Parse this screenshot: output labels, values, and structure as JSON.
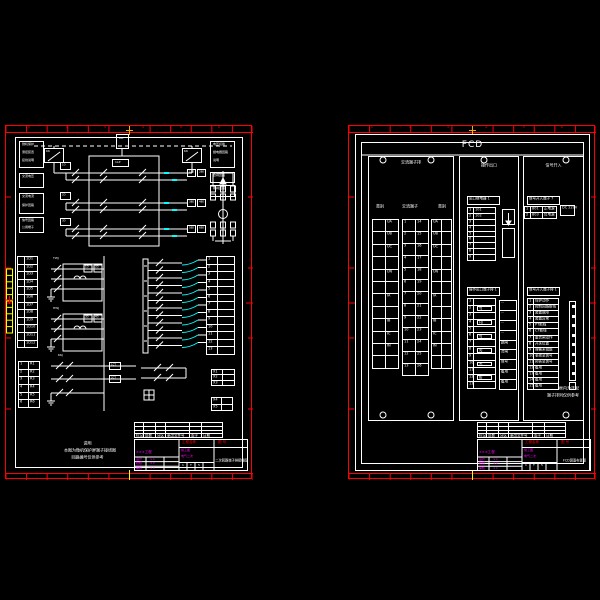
{
  "canvas": {
    "background": "#000000"
  },
  "palette": {
    "line": "#ffffff",
    "frame": "#ff0000",
    "highlight": "#ffff00",
    "wire_accent": "#00ffff",
    "fill_text": "#ff00ff",
    "center_mark": "#ffaa00"
  },
  "left_sheet": {
    "zone_numbers": [
      "1",
      "2",
      "3",
      "4",
      "5",
      "6"
    ],
    "legend_boxes": [
      [
        "微机保护",
        "测控装置",
        "接线说明"
      ],
      [
        "交流电压"
      ],
      [
        "交流电流",
        "保护回路"
      ],
      [
        "信号回路",
        "公用端子"
      ]
    ],
    "switch_boxes": [
      "KK",
      "KK"
    ],
    "top_right_boxes": [
      [
        "电压切换",
        "继电器回路",
        "说明"
      ],
      [
        "合闸回路"
      ],
      [
        "跳闸回路"
      ]
    ],
    "center_component": "DK",
    "pressure_plate": "1LP",
    "circuit_rows": [
      {
        "label": "1D",
        "boxes": [
          "1BD",
          "2BD"
        ]
      },
      {
        "label": "2D",
        "boxes": [
          "3BD",
          "4BD"
        ]
      },
      {
        "label": "3D",
        "boxes": [
          "5BD",
          "6BD"
        ]
      }
    ],
    "relay_groups": [
      {
        "label": "TWJ",
        "boxes": [
          "1D",
          "2D"
        ]
      },
      {
        "label": "HWJ",
        "boxes": [
          "3D",
          "4D"
        ]
      }
    ],
    "side_table_rows": [
      "1D1",
      "1D2",
      "1D3",
      "1D4",
      "1D5",
      "1D6",
      "1D7",
      "1D8",
      "1D9",
      "1D10",
      "1D11",
      "1D12"
    ],
    "side_table2_rows": [
      [
        "1",
        "R1"
      ],
      [
        "2",
        "R2"
      ],
      [
        "3",
        "R3"
      ],
      [
        "4",
        "R4"
      ],
      [
        "5",
        "R5"
      ],
      [
        "6",
        "R6"
      ]
    ],
    "terminal_labels": [
      "1",
      "2",
      "3",
      "4",
      "5",
      "6",
      "7",
      "8",
      "9",
      "10",
      "11",
      "12",
      "13"
    ],
    "switch_label": "KKJ",
    "ct_boxes": [
      "1CT",
      "2CT"
    ],
    "aux_table1": [
      "X1",
      "X2",
      "X3"
    ],
    "aux_table2": [
      "X4",
      "X5"
    ],
    "notes": [
      "说明",
      "本图为微机保护屏端子接线图",
      "回路编号仅供参考"
    ]
  },
  "right_sheet": {
    "title": "FCD",
    "panels": [
      {
        "title": "交流端子排",
        "headers": [
          "类别",
          "交流端子",
          "类别"
        ],
        "grid_a": [
          "UA",
          "UB",
          "UC",
          "",
          "UN",
          "",
          "IA",
          "",
          "IB",
          "IC",
          "IN",
          ""
        ],
        "grid_b_left": [
          "1",
          "2",
          "3",
          "4",
          "5",
          "6",
          "7",
          "8",
          "9",
          "10",
          "11",
          "12",
          "13"
        ],
        "grid_b_right": [
          "14",
          "15",
          "16",
          "17",
          "18",
          "19",
          "20",
          "21",
          "22",
          "23",
          "24",
          "25",
          "26"
        ],
        "grid_c": [
          "UA",
          "UB",
          "UC",
          "",
          "UN",
          "",
          "IA",
          "",
          "IB",
          "IC",
          "IN",
          ""
        ]
      },
      {
        "title": "操作出口",
        "header1": "出口继电器 1",
        "table1_left": [
          "1",
          "2",
          "3",
          "4",
          "5",
          "6",
          "7",
          "8",
          "9"
        ],
        "table1_right": [
          "101",
          "102",
          "",
          "",
          "",
          "",
          "",
          "",
          ""
        ],
        "header2": "操作出口端子排 1",
        "table2_left": [
          "1",
          "2",
          "3",
          "4",
          "5",
          "6",
          "7",
          "8",
          "9",
          "10",
          "11",
          "12",
          "13"
        ],
        "coil_labels": [
          "TJ",
          "HJ",
          "YJ",
          "XJ",
          "ZJ",
          "BJ"
        ],
        "relay_cells": [
          "···",
          "···",
          "···",
          "···",
          "跳闸",
          "合闸",
          "信号",
          "备用",
          "备用"
        ],
        "arrow_box": "↓"
      },
      {
        "title": "信号开入",
        "header1": "信号开入端子 7",
        "table1": [
          [
            "1",
            "801",
            "正电源"
          ],
          [
            "2",
            "803",
            "负电源"
          ]
        ],
        "aux_box": "DC 220V",
        "header2": "信号开入端子排 1",
        "table2_left": [
          "1",
          "2",
          "3",
          "4",
          "5",
          "6",
          "7",
          "8",
          "9",
          "10",
          "11",
          "12",
          "13",
          "14",
          "15"
        ],
        "table2_right": [
          "保护动作",
          "控制回路断线",
          "装置故障",
          "装置异常",
          "PT断线",
          "CT断线",
          "重合闸动作",
          "开关位置",
          "弹簧未储能",
          "事故总信号",
          "预告总信号",
          "备用",
          "备用",
          "备用",
          "备用"
        ],
        "notes": [
          "注: 虚线框内为选配",
          "端子排列仅供参考"
        ]
      }
    ]
  },
  "title_blocks": {
    "revision_headers": [
      "标记",
      "处数",
      "分区",
      "更改文件号",
      "签字",
      "日期"
    ],
    "red_label_left": "工程名称",
    "red_label_right": "图  号",
    "project": "×××工程",
    "sign_rows": [
      [
        "设计",
        "××"
      ],
      [
        "校核",
        "××"
      ],
      [
        "审核",
        "××"
      ]
    ],
    "stage": "施工图",
    "specialty": "电气二次",
    "scale_cells": [
      "1",
      "T",
      "5"
    ],
    "doc_title_left": "二次回路端子排接线图",
    "doc_title_right": "FCD屏面布置图"
  }
}
